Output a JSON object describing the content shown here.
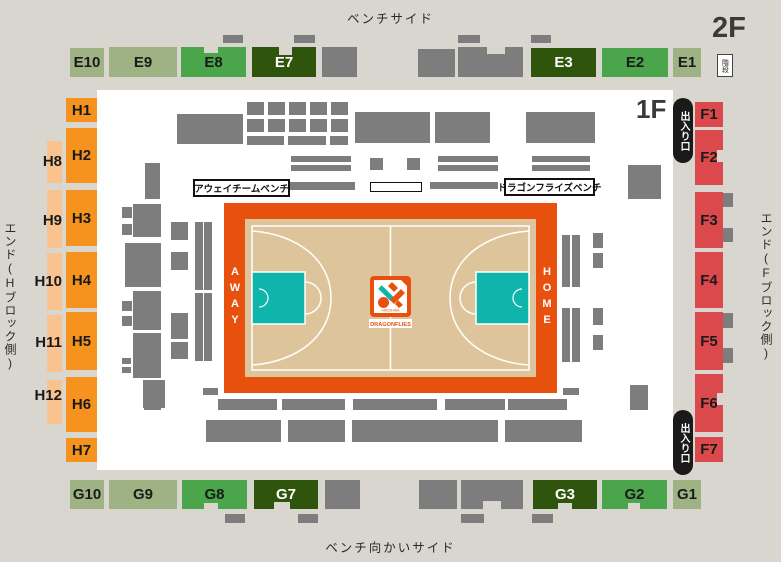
{
  "colors": {
    "bg": "#d8d6ce",
    "map-bg": "#ffffff",
    "sage": "#9eb284",
    "green": "#4aa54b",
    "dark-green": "#2f540c",
    "orange": "#f6921e",
    "peach": "#f9c28f",
    "red": "#dc494d",
    "gray": "#7d7d7d",
    "court-orange": "#e8500e",
    "court-floor": "#dec49a",
    "key-teal": "#0fb5ab",
    "badge": "#1a1a1a"
  },
  "labels": {
    "bench_side": "ベンチサイド",
    "opposite_bench_side": "ベンチ向かいサイド",
    "h_end": "エンド(Hブロック側)",
    "f_end": "エンド(Fブロック側)",
    "floor_2f": "2F",
    "floor_1f": "1F",
    "stairs": "階段",
    "exit": "出入り口",
    "away_bench": "アウェイチームベンチ",
    "home_bench": "ドラゴンフライズベンチ",
    "away": "AWAY",
    "home": "HOME",
    "logo_main": "DRAGONFLIES",
    "logo_sub": "HIROSHIMA"
  },
  "seats": [
    [
      "E10",
      "sage",
      70,
      48,
      34,
      29
    ],
    [
      "E9",
      "sage",
      109,
      47,
      68,
      30
    ],
    [
      "E8",
      "green",
      181,
      47,
      65,
      30
    ],
    [
      "E7",
      "dark",
      252,
      47,
      64,
      30
    ],
    [
      "E3",
      "dark",
      531,
      48,
      65,
      29
    ],
    [
      "E2",
      "green",
      602,
      48,
      66,
      29
    ],
    [
      "E1",
      "sage",
      673,
      48,
      28,
      29
    ],
    [
      "G10",
      "sage",
      70,
      480,
      34,
      29
    ],
    [
      "G9",
      "sage",
      109,
      480,
      68,
      29
    ],
    [
      "G8",
      "green",
      182,
      480,
      65,
      29
    ],
    [
      "G7",
      "dark",
      254,
      480,
      64,
      29
    ],
    [
      "G3",
      "dark",
      533,
      480,
      64,
      29
    ],
    [
      "G2",
      "green",
      602,
      480,
      65,
      29
    ],
    [
      "G1",
      "sage",
      673,
      480,
      28,
      29
    ],
    [
      "H1",
      "orange",
      66,
      98,
      31,
      24
    ],
    [
      "H2",
      "orange",
      66,
      128,
      31,
      55
    ],
    [
      "H3",
      "orange",
      66,
      190,
      31,
      56
    ],
    [
      "H4",
      "orange",
      66,
      252,
      31,
      56
    ],
    [
      "H5",
      "orange",
      66,
      312,
      31,
      58
    ],
    [
      "H6",
      "orange",
      66,
      377,
      31,
      55
    ],
    [
      "H7",
      "orange",
      66,
      438,
      31,
      24
    ],
    [
      "F1",
      "red",
      695,
      102,
      28,
      25
    ],
    [
      "F2",
      "red",
      695,
      130,
      28,
      55
    ],
    [
      "F3",
      "red",
      695,
      192,
      28,
      56
    ],
    [
      "F4",
      "red",
      695,
      252,
      28,
      56
    ],
    [
      "F5",
      "red",
      695,
      312,
      28,
      58
    ],
    [
      "F6",
      "red",
      695,
      374,
      28,
      58
    ],
    [
      "F7",
      "red",
      695,
      437,
      28,
      25
    ]
  ],
  "outer_seats": [
    {
      "id": "H8",
      "x": 47,
      "y": 141,
      "w": 15,
      "h": 42,
      "lx": 22,
      "ly": 153
    },
    {
      "id": "H9",
      "x": 47,
      "y": 190,
      "w": 15,
      "h": 58,
      "lx": 22,
      "ly": 212
    },
    {
      "id": "H10",
      "x": 47,
      "y": 253,
      "w": 15,
      "h": 57,
      "lx": 22,
      "ly": 273
    },
    {
      "id": "H11",
      "x": 47,
      "y": 315,
      "w": 15,
      "h": 57,
      "lx": 22,
      "ly": 334
    },
    {
      "id": "H12",
      "x": 47,
      "y": 380,
      "w": 15,
      "h": 44,
      "lx": 22,
      "ly": 387
    }
  ],
  "furniture": [
    [
      322,
      47,
      35,
      30
    ],
    [
      418,
      49,
      37,
      28
    ],
    [
      458,
      47,
      65,
      30
    ],
    [
      223,
      35,
      20,
      8
    ],
    [
      294,
      35,
      21,
      8
    ],
    [
      458,
      35,
      22,
      8
    ],
    [
      531,
      35,
      20,
      8
    ],
    [
      325,
      480,
      35,
      29
    ],
    [
      419,
      480,
      38,
      29
    ],
    [
      461,
      480,
      62,
      29
    ],
    [
      225,
      514,
      20,
      9
    ],
    [
      298,
      514,
      20,
      9
    ],
    [
      461,
      514,
      23,
      9
    ],
    [
      532,
      514,
      21,
      9
    ],
    [
      177,
      114,
      66,
      30
    ],
    [
      247,
      102,
      17,
      13
    ],
    [
      268,
      102,
      17,
      13
    ],
    [
      289,
      102,
      17,
      13
    ],
    [
      310,
      102,
      17,
      13
    ],
    [
      331,
      102,
      17,
      13
    ],
    [
      247,
      119,
      17,
      13
    ],
    [
      268,
      119,
      17,
      13
    ],
    [
      289,
      119,
      17,
      13
    ],
    [
      310,
      119,
      17,
      13
    ],
    [
      331,
      119,
      17,
      13
    ],
    [
      247,
      136,
      37,
      9
    ],
    [
      288,
      136,
      38,
      9
    ],
    [
      330,
      136,
      18,
      9
    ],
    [
      355,
      112,
      75,
      31
    ],
    [
      435,
      112,
      55,
      31
    ],
    [
      526,
      112,
      69,
      31
    ],
    [
      145,
      163,
      15,
      36
    ],
    [
      291,
      156,
      60,
      6
    ],
    [
      291,
      165,
      60,
      6
    ],
    [
      438,
      156,
      60,
      6
    ],
    [
      438,
      165,
      60,
      6
    ],
    [
      532,
      156,
      58,
      6
    ],
    [
      532,
      165,
      58,
      6
    ],
    [
      370,
      158,
      13,
      12
    ],
    [
      407,
      158,
      13,
      12
    ],
    [
      290,
      182,
      65,
      8
    ],
    [
      430,
      182,
      68,
      7
    ],
    [
      628,
      165,
      33,
      34
    ],
    [
      122,
      207,
      10,
      11
    ],
    [
      122,
      224,
      10,
      11
    ],
    [
      133,
      204,
      28,
      33
    ],
    [
      125,
      243,
      36,
      44
    ],
    [
      133,
      291,
      28,
      39
    ],
    [
      122,
      301,
      10,
      10
    ],
    [
      122,
      316,
      10,
      10
    ],
    [
      133,
      333,
      28,
      45
    ],
    [
      122,
      358,
      9,
      6
    ],
    [
      122,
      367,
      9,
      6
    ],
    [
      143,
      380,
      22,
      28
    ],
    [
      171,
      222,
      17,
      18
    ],
    [
      171,
      252,
      17,
      18
    ],
    [
      171,
      313,
      17,
      26
    ],
    [
      171,
      342,
      17,
      17
    ],
    [
      195,
      222,
      8,
      68
    ],
    [
      204,
      222,
      8,
      68
    ],
    [
      195,
      293,
      8,
      68
    ],
    [
      204,
      293,
      8,
      68
    ],
    [
      562,
      235,
      8,
      52
    ],
    [
      572,
      235,
      8,
      52
    ],
    [
      562,
      308,
      8,
      54
    ],
    [
      572,
      308,
      8,
      54
    ],
    [
      593,
      233,
      10,
      15
    ],
    [
      593,
      253,
      10,
      15
    ],
    [
      593,
      308,
      10,
      17
    ],
    [
      593,
      335,
      10,
      15
    ],
    [
      723,
      193,
      10,
      14
    ],
    [
      723,
      228,
      10,
      14
    ],
    [
      723,
      313,
      10,
      15
    ],
    [
      723,
      348,
      10,
      15
    ],
    [
      203,
      388,
      15,
      7
    ],
    [
      563,
      388,
      16,
      7
    ],
    [
      144,
      385,
      17,
      25
    ],
    [
      630,
      385,
      18,
      25
    ],
    [
      218,
      399,
      59,
      11
    ],
    [
      282,
      399,
      63,
      11
    ],
    [
      353,
      399,
      84,
      11
    ],
    [
      445,
      399,
      60,
      11
    ],
    [
      508,
      399,
      59,
      11
    ],
    [
      206,
      420,
      75,
      22
    ],
    [
      288,
      420,
      57,
      22
    ],
    [
      352,
      420,
      85,
      22
    ],
    [
      433,
      420,
      65,
      22
    ],
    [
      505,
      420,
      77,
      22
    ]
  ],
  "notches": [
    [
      204,
      47,
      14,
      6
    ],
    [
      279,
      47,
      13,
      8
    ],
    [
      487,
      47,
      18,
      7
    ],
    [
      204,
      503,
      14,
      6
    ],
    [
      274,
      502,
      16,
      8
    ],
    [
      483,
      501,
      18,
      8
    ],
    [
      558,
      503,
      14,
      6
    ],
    [
      628,
      503,
      12,
      6
    ],
    [
      717,
      150,
      6,
      12
    ],
    [
      717,
      393,
      6,
      12
    ]
  ],
  "exits": [
    [
      673,
      98,
      20,
      65
    ],
    [
      673,
      410,
      20,
      65
    ]
  ]
}
